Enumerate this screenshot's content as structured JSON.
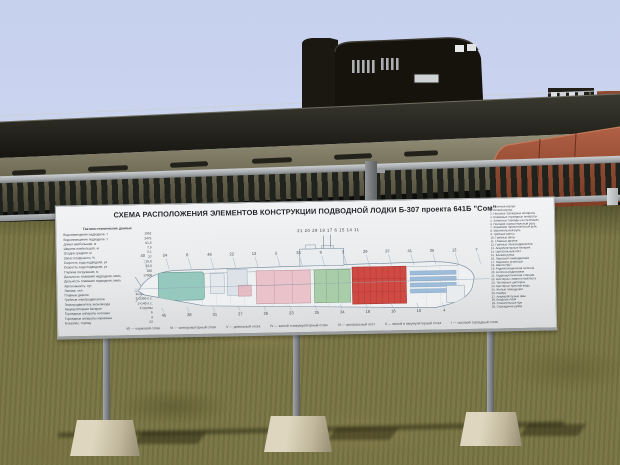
{
  "sign": {
    "title": "СХЕМА РАСПОЛОЖЕНИЯ ЭЛЕМЕНТОВ КОНСТРУКЦИИ ПОДВОДНОЙ ЛОДКИ Б-307 проекта 641Б \"Сом\"",
    "specs_header": "Тактико-технические данные",
    "specs": [
      {
        "label": "Водоизмещение надводное, т",
        "value": "1952"
      },
      {
        "label": "Водоизмещение подводное, т",
        "value": "2475"
      },
      {
        "label": "Длина наибольшая, м",
        "value": "91,3"
      },
      {
        "label": "Ширина наибольшая, м",
        "value": "7,5"
      },
      {
        "label": "Осадка средняя, м",
        "value": "5,1"
      },
      {
        "label": "Запас плавучести, %",
        "value": "27"
      },
      {
        "label": "Скорость хода надводная, уз",
        "value": "16,8"
      },
      {
        "label": "Скорость хода подводная, уз",
        "value": "16,0"
      },
      {
        "label": "Глубина погружения, м",
        "value": "280"
      },
      {
        "label": "Дальность плавания надводная, миль",
        "value": "17900"
      },
      {
        "label": "Дальность плавания подводная, миль",
        "value": "400"
      },
      {
        "label": "Автономность, сут",
        "value": "90"
      },
      {
        "label": "Экипаж, чел",
        "value": "78"
      },
      {
        "label": "Главные дизели",
        "value": "3×2000 л.с."
      },
      {
        "label": "Гребные электродвигатели",
        "value": "2×1350 л.с."
      },
      {
        "label": "Электродвигатель экономхода",
        "value": "1×140 л.с."
      },
      {
        "label": "Аккумуляторная батарея",
        "value": "4 группы"
      },
      {
        "label": "Торпедные аппараты носовые",
        "value": "6"
      },
      {
        "label": "Торпедные аппараты кормовые",
        "value": "4"
      },
      {
        "label": "Боезапас, торпед",
        "value": "22"
      }
    ],
    "legend": [
      "1. Прочный корпус",
      "2. Лёгкий корпус",
      "3. Носовые торпедные аппараты",
      "4. Кормовые торпедные аппараты",
      "5. Запасные торпеды на стеллажах",
      "6. Носовой горизонтальный руль",
      "7. Кормовой горизонтальный руль",
      "8. Вертикальный руль",
      "9. Гребные винты",
      "10. Гребные валы",
      "11. Главные дизели",
      "12. Гребные электродвигатели",
      "13. Аккумуляторные батареи",
      "14. Центральный пост",
      "15. Боевая рубка",
      "16. Перископ командирский",
      "17. Перископ зенитный",
      "18. Шахта РДП",
      "19. Радиолокационная антенна",
      "20. Антенна радиосвязи",
      "21. Гидроакустическая станция",
      "22. Цистерны главного балласта",
      "23. Топливные цистерны",
      "24. Цистерны пресной воды",
      "25. Жилые помещения",
      "26. Камбуз",
      "27. Аккумуляторные ямы",
      "28. Входные люки",
      "29. Спасательные буи",
      "30. Ограждение рубки"
    ],
    "diagram": {
      "top_numbers": "21 20 28 19 17  6 15 14 11",
      "callouts_above": [
        "40",
        "24",
        "8",
        "46",
        "22",
        "13",
        "5",
        "33",
        "9",
        "3",
        "29",
        "37",
        "41",
        "35",
        "12",
        "7"
      ],
      "callouts_below": [
        "45",
        "38",
        "31",
        "27",
        "26",
        "23",
        "25",
        "34",
        "18",
        "16",
        "10",
        "4"
      ],
      "compartments": [
        "VII — кормовой отсек",
        "VI — электромоторный отсек",
        "V — дизельный отсек",
        "IV — жилой и аккумуляторный отсек",
        "III — центральный пост",
        "II — жилой и аккумуляторный отсек",
        "I — носовой торпедный отсек"
      ]
    }
  },
  "colors": {
    "sky": "#cbd4ef",
    "hull_olive": "#8f8b76",
    "hull_dark": "#17160f",
    "hull_rust": "#9b4d38",
    "grass": "#7c7848",
    "sign_bg": "#eceeef",
    "diagram_teal": "#96c9bd",
    "diagram_pink": "#e9c2ca",
    "diagram_green": "#a9cda9",
    "diagram_red": "#cf4a42",
    "diagram_blue": "#9dbcd9"
  }
}
